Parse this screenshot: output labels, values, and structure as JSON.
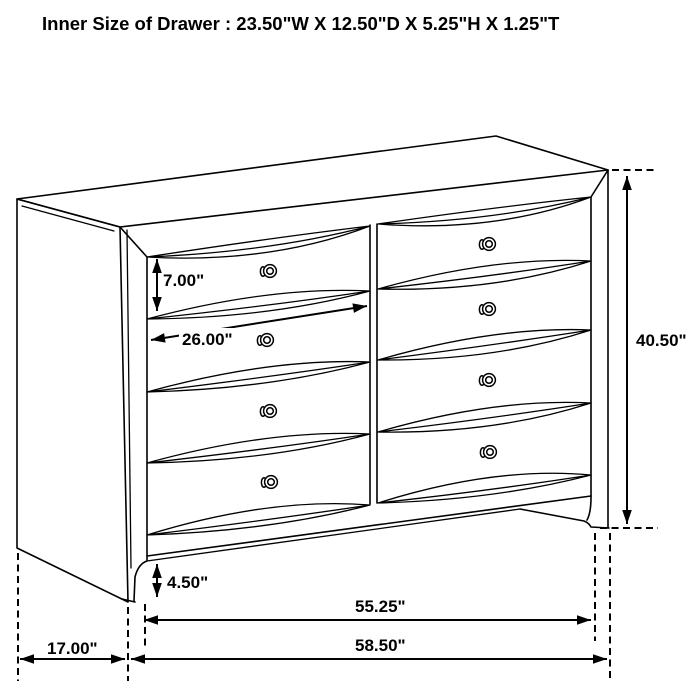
{
  "title": "Inner Size of Drawer : 23.50\"W X 12.50\"D X 5.25\"H X 1.25\"T",
  "inner_drawer_size": {
    "width": "23.50\"W",
    "depth": "12.50\"D",
    "height": "5.25\"H",
    "thickness": "1.25\"T"
  },
  "figure": {
    "type": "furniture-dimension-line-drawing",
    "item": "dresser with 8 drawers (2 columns x 4 rows) and round knobs",
    "colors": {
      "line": "#000000",
      "background": "#ffffff"
    },
    "dimensions": [
      {
        "name": "drawer-front-height",
        "label": "7.00\""
      },
      {
        "name": "drawer-width",
        "label": "26.00\""
      },
      {
        "name": "overall-height",
        "label": "40.50\""
      },
      {
        "name": "base-height",
        "label": "4.50\""
      },
      {
        "name": "front-width",
        "label": "55.25\""
      },
      {
        "name": "overall-width",
        "label": "58.50\""
      },
      {
        "name": "depth",
        "label": "17.00\""
      }
    ]
  }
}
